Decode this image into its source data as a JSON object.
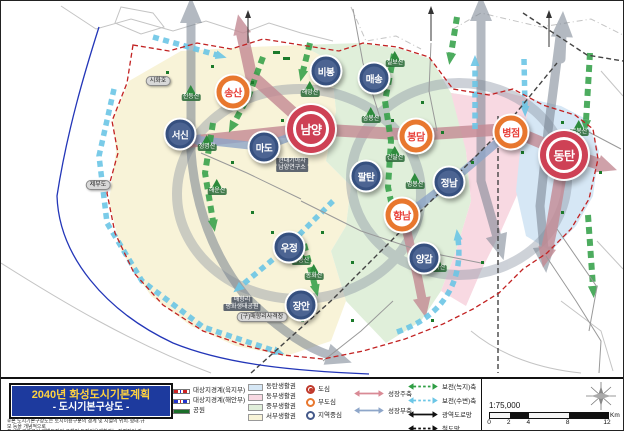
{
  "title_block": {
    "line1": "2040년 화성도시기본계획",
    "line2": "- 도시기본구상도 -"
  },
  "footnote": {
    "line1": "※본 도시기본구상도는 토지이용구분의 경계 및 시설의 위치·형태·규모 등을 개념적으로",
    "line2": "표시한 것으로서 개별토지의 구체적 토지이용계획과는 직접적인 관련이 없음."
  },
  "legend": {
    "boundaries": [
      {
        "label": "대상지경계(육지부)",
        "type": "dash",
        "c1": "#cc2222",
        "c2": "#2233cc"
      },
      {
        "label": "대상지경계(해안부)",
        "type": "dash",
        "c1": "#2233cc",
        "c2": "#cc2222"
      },
      {
        "label": "공원",
        "type": "fill",
        "color": "#1b6e2a"
      }
    ],
    "zones": [
      {
        "label": "동탄생활권",
        "color": "#d6e7f5"
      },
      {
        "label": "동부생활권",
        "color": "#f8d9e2"
      },
      {
        "label": "중부생활권",
        "color": "#e0efda"
      },
      {
        "label": "서부생활권",
        "color": "#f8f3d8"
      }
    ],
    "centers": [
      {
        "label": "도심",
        "ring": "#c0392b",
        "dot": "#c0392b"
      },
      {
        "label": "부도심",
        "ring": "#e8772e"
      },
      {
        "label": "지역중심",
        "ring": "#44598a"
      }
    ],
    "axes_growth": [
      {
        "label": "성장주축",
        "color": "#d98a95",
        "dashed": false
      },
      {
        "label": "성장부축",
        "color": "#8ea6c9",
        "dashed": false
      }
    ],
    "axes_conserve": [
      {
        "label": "보전(녹지)축",
        "color": "#2f9e44",
        "dashed": true
      },
      {
        "label": "보전(수변)축",
        "color": "#6cc6e6",
        "dashed": true
      },
      {
        "label": "광역도로망",
        "color": "#111111",
        "dashed": false
      },
      {
        "label": "철도망",
        "color": "#111111",
        "dashed": true
      }
    ],
    "scale": {
      "ratio": "1:75,000",
      "ticks": [
        "0",
        "2",
        "4",
        "8",
        "12"
      ],
      "unit": "Km"
    }
  },
  "map": {
    "nodes": [
      {
        "name": "남양",
        "type": "dosim",
        "x": 310,
        "y": 128
      },
      {
        "name": "동탄",
        "type": "dosim",
        "x": 563,
        "y": 154
      },
      {
        "name": "송산",
        "type": "budosim",
        "x": 232,
        "y": 91
      },
      {
        "name": "봉담",
        "type": "budosim",
        "x": 415,
        "y": 135
      },
      {
        "name": "병점",
        "type": "budosim",
        "x": 510,
        "y": 131
      },
      {
        "name": "향남",
        "type": "budosim",
        "x": 401,
        "y": 214
      },
      {
        "name": "서신",
        "type": "jiyeok",
        "x": 179,
        "y": 133
      },
      {
        "name": "마도",
        "type": "jiyeok",
        "x": 263,
        "y": 146
      },
      {
        "name": "비봉",
        "type": "jiyeok",
        "x": 325,
        "y": 70
      },
      {
        "name": "매송",
        "type": "jiyeok",
        "x": 373,
        "y": 77
      },
      {
        "name": "팔탄",
        "type": "jiyeok",
        "x": 365,
        "y": 175
      },
      {
        "name": "정남",
        "type": "jiyeok",
        "x": 448,
        "y": 181
      },
      {
        "name": "양감",
        "type": "jiyeok",
        "x": 423,
        "y": 257
      },
      {
        "name": "우정",
        "type": "jiyeok",
        "x": 288,
        "y": 246
      },
      {
        "name": "장안",
        "type": "jiyeok",
        "x": 300,
        "y": 304
      }
    ],
    "mountains": [
      {
        "name": "천등산",
        "x": 190,
        "y": 100
      },
      {
        "name": "해망산",
        "x": 309,
        "y": 96
      },
      {
        "name": "칠보산",
        "x": 394,
        "y": 66
      },
      {
        "name": "삼봉산",
        "x": 370,
        "y": 122
      },
      {
        "name": "건달산",
        "x": 394,
        "y": 161
      },
      {
        "name": "명봉산",
        "x": 414,
        "y": 188
      },
      {
        "name": "청명산",
        "x": 206,
        "y": 150
      },
      {
        "name": "해운산",
        "x": 216,
        "y": 194
      },
      {
        "name": "쌍봉산",
        "x": 300,
        "y": 264
      },
      {
        "name": "봉화산",
        "x": 313,
        "y": 279
      },
      {
        "name": "무봉산",
        "x": 578,
        "y": 135
      },
      {
        "name": "초록산",
        "x": 436,
        "y": 271
      }
    ],
    "labels": [
      {
        "lines": [
          "시화호"
        ],
        "x": 157,
        "y": 80,
        "style": "oval"
      },
      {
        "lines": [
          "제부도"
        ],
        "x": 97,
        "y": 184,
        "style": "oval"
      },
      {
        "lines": [
          "현대기아차",
          "남양연구소"
        ],
        "x": 291,
        "y": 164,
        "style": "dark"
      },
      {
        "lines": [
          "매향리",
          "평화생태공원"
        ],
        "x": 241,
        "y": 303,
        "style": "dark"
      },
      {
        "lines": [
          "(구)매향리사격장"
        ],
        "x": 261,
        "y": 316,
        "style": "oval"
      }
    ]
  }
}
